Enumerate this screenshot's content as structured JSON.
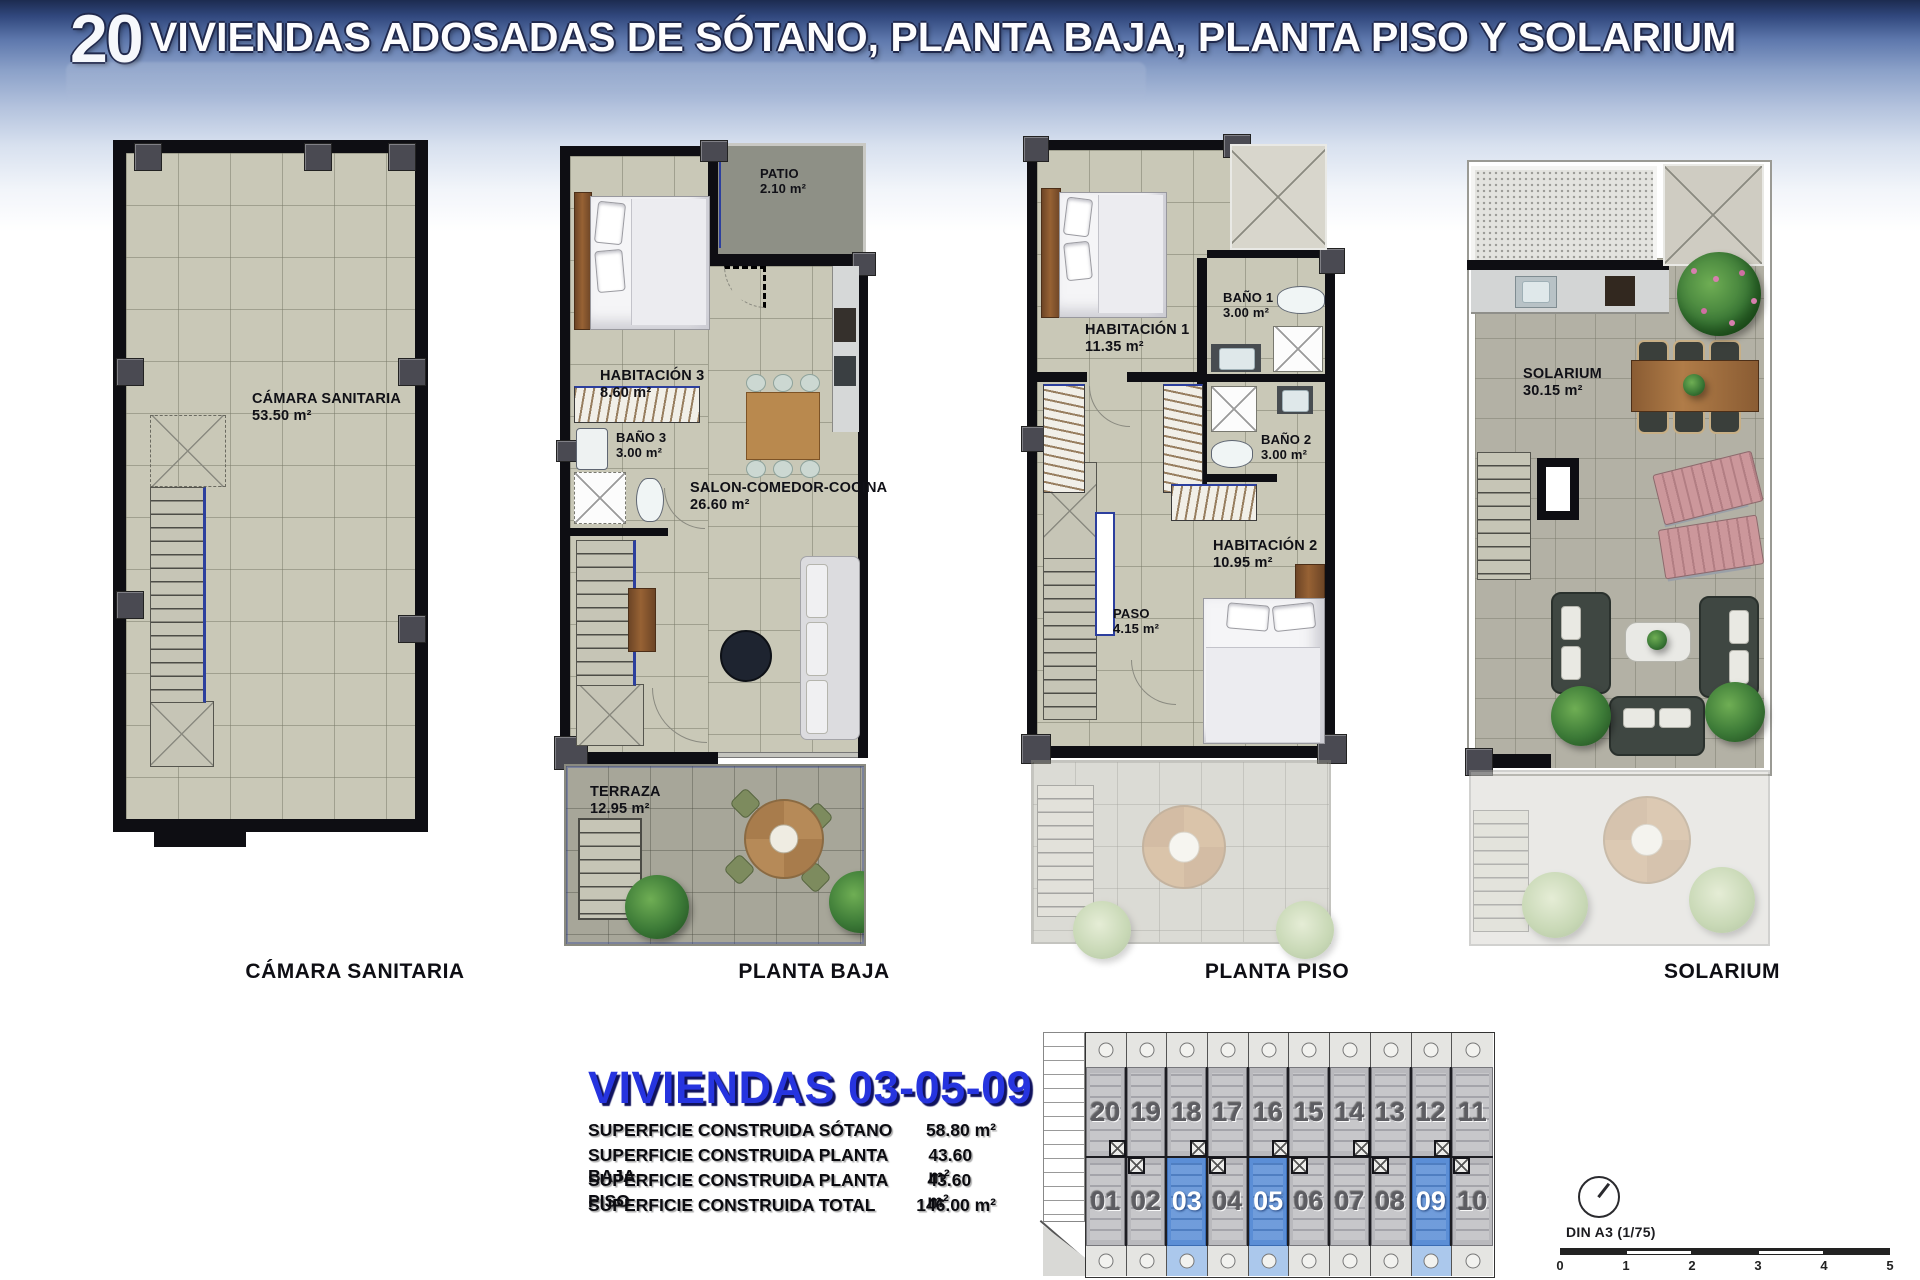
{
  "header": {
    "number": "20",
    "title": "VIVIENDAS ADOSADAS DE SÓTANO, PLANTA BAJA, PLANTA PISO Y SOLARIUM"
  },
  "plans": {
    "camara": {
      "caption": "CÁMARA SANITARIA",
      "room": {
        "name": "CÁMARA SANITARIA",
        "area": "53.50 m²"
      }
    },
    "baja": {
      "caption": "PLANTA BAJA",
      "rooms": {
        "patio": {
          "name": "PATIO",
          "area": "2.10 m²"
        },
        "hab3": {
          "name": "HABITACIÓN 3",
          "area": "8.60 m²"
        },
        "bano3": {
          "name": "BAÑO 3",
          "area": "3.00 m²"
        },
        "salon": {
          "name": "SALON-COMEDOR-COCINA",
          "area": "26.60 m²"
        },
        "terraza": {
          "name": "TERRAZA",
          "area": "12.95 m²"
        }
      }
    },
    "piso": {
      "caption": "PLANTA PISO",
      "rooms": {
        "hab1": {
          "name": "HABITACIÓN 1",
          "area": "11.35 m²"
        },
        "bano1": {
          "name": "BAÑO 1",
          "area": "3.00 m²"
        },
        "bano2": {
          "name": "BAÑO 2",
          "area": "3.00 m²"
        },
        "hab2": {
          "name": "HABITACIÓN 2",
          "area": "10.95 m²"
        },
        "paso": {
          "name": "PASO",
          "area": "4.15 m²"
        }
      }
    },
    "solarium": {
      "caption": "SOLARIUM",
      "room": {
        "name": "SOLARIUM",
        "area": "30.15 m²"
      }
    }
  },
  "summary": {
    "title": "VIVIENDAS 03-05-09",
    "rows": [
      {
        "label": "SUPERFICIE CONSTRUIDA SÓTANO",
        "value": "58.80 m²"
      },
      {
        "label": "SUPERFICIE CONSTRUIDA PLANTA BAJA",
        "value": "43.60 m²"
      },
      {
        "label": "SUPERFICIE CONSTRUIDA PLANTA PISO",
        "value": "43.60 m²"
      },
      {
        "label": "SUPERFICIE CONSTRUIDA TOTAL",
        "value": "146.00 m²"
      }
    ]
  },
  "siteplan": {
    "top_row": [
      "20",
      "19",
      "18",
      "17",
      "16",
      "15",
      "14",
      "13",
      "12",
      "11"
    ],
    "bottom_row": [
      "01",
      "02",
      "03",
      "04",
      "05",
      "06",
      "07",
      "08",
      "09",
      "10"
    ],
    "highlighted": [
      "03",
      "05",
      "09"
    ],
    "highlight_color": "#5b8ed6"
  },
  "scale_indicator": {
    "label": "DIN A3 (1/75)",
    "ticks": [
      "0",
      "1",
      "2",
      "3",
      "4",
      "5"
    ]
  },
  "colors": {
    "header_top": "#1c2b50",
    "accent_blue": "#2c3f9e",
    "title_blue": "#2634df",
    "highlight_unit": "#5b8ed6"
  }
}
